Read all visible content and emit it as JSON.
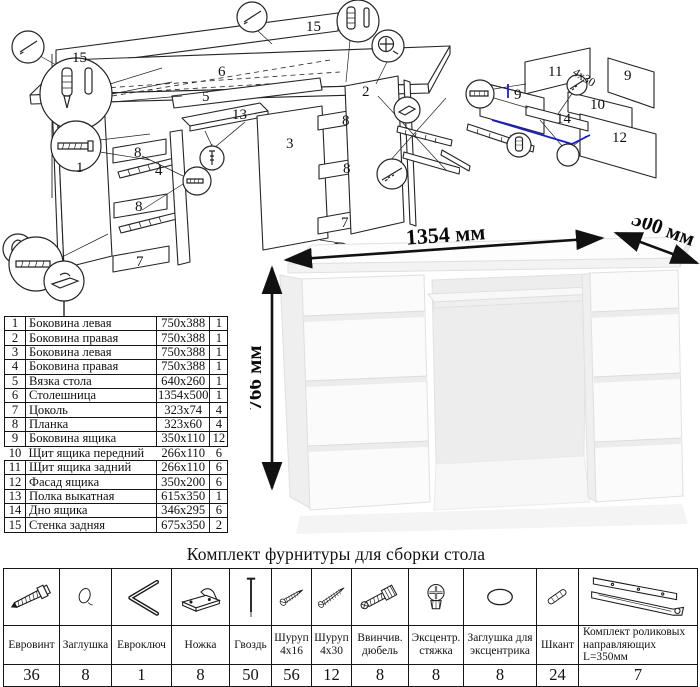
{
  "main_diagram": {
    "labels": [
      {
        "t": "15",
        "x": 72,
        "y": 62
      },
      {
        "t": "6",
        "x": 218,
        "y": 76
      },
      {
        "t": "15",
        "x": 306,
        "y": 31
      },
      {
        "t": "1",
        "x": 76,
        "y": 172
      },
      {
        "t": "8",
        "x": 134,
        "y": 157
      },
      {
        "t": "4",
        "x": 155,
        "y": 175
      },
      {
        "t": "8",
        "x": 135,
        "y": 211
      },
      {
        "t": "7",
        "x": 136,
        "y": 266
      },
      {
        "t": "5",
        "x": 202,
        "y": 101
      },
      {
        "t": "13",
        "x": 232,
        "y": 119
      },
      {
        "t": "3",
        "x": 286,
        "y": 148
      },
      {
        "t": "2",
        "x": 362,
        "y": 96
      },
      {
        "t": "8",
        "x": 342,
        "y": 125
      },
      {
        "t": "8",
        "x": 343,
        "y": 173
      },
      {
        "t": "7",
        "x": 341,
        "y": 227
      }
    ]
  },
  "drawer_diagram": {
    "accent_blue": "#1c1ccd",
    "labels": [
      {
        "t": "11",
        "x": 108,
        "y": 48
      },
      {
        "t": "9",
        "x": 184,
        "y": 52
      },
      {
        "t": "9",
        "x": 74,
        "y": 71
      },
      {
        "t": "10",
        "x": 150,
        "y": 81
      },
      {
        "t": "12",
        "x": 172,
        "y": 114
      },
      {
        "t": "14",
        "x": 116,
        "y": 95
      },
      {
        "t": "4x30",
        "x": 132,
        "y": 46,
        "r": 33,
        "s": 12
      }
    ]
  },
  "parts_table": {
    "rows": [
      [
        "1",
        "Боковина левая",
        "750x388",
        "1"
      ],
      [
        "2",
        "Боковина правая",
        "750x388",
        "1"
      ],
      [
        "3",
        "Боковина левая",
        "750x388",
        "1"
      ],
      [
        "4",
        "Боковина правая",
        "750x388",
        "1"
      ],
      [
        "5",
        "Вязка стола",
        "640x260",
        "1"
      ],
      [
        "6",
        "Столешница",
        "1354x500",
        "1"
      ],
      [
        "7",
        "Цоколь",
        "323x74",
        "4"
      ],
      [
        "8",
        "Планка",
        "323x60",
        "4"
      ],
      [
        "9",
        "Боковина ящика",
        "350x110",
        "12"
      ],
      [
        "10",
        "Щит ящика передний",
        "266x110",
        "6"
      ],
      [
        "11",
        "Щит ящика задний",
        "266x110",
        "6"
      ],
      [
        "12",
        "Фасад ящика",
        "350x200",
        "6"
      ],
      [
        "13",
        "Полка выкатная",
        "615x350",
        "1"
      ],
      [
        "14",
        "Дно ящика",
        "346x295",
        "6"
      ],
      [
        "15",
        "Стенка задняя",
        "675x350",
        "2"
      ]
    ]
  },
  "photo": {
    "width_label": "1354 мм",
    "depth_label": "500 мм",
    "height_label": "766 мм"
  },
  "hardware": {
    "title": "Комплект фурнитуры для сборки стола",
    "items": [
      {
        "name": "Евровинт",
        "qty": "36",
        "icon": "euro-screw"
      },
      {
        "name": "Заглушка",
        "qty": "8",
        "icon": "cap"
      },
      {
        "name": "Евроключ",
        "qty": "1",
        "icon": "hex-key"
      },
      {
        "name": "Ножка",
        "qty": "8",
        "icon": "foot"
      },
      {
        "name": "Гвоздь",
        "qty": "50",
        "icon": "nail"
      },
      {
        "name": "Шуруп 4x16",
        "qty": "56",
        "icon": "screw-small"
      },
      {
        "name": "Шуруп 4x30",
        "qty": "12",
        "icon": "screw-long"
      },
      {
        "name": "Ввинчив. дюбель",
        "qty": "8",
        "icon": "dowel"
      },
      {
        "name": "Эксцентр. стяжка",
        "qty": "8",
        "icon": "cam-lock"
      },
      {
        "name": "Заглушка для эксцентрика",
        "qty": "8",
        "icon": "cam-cap"
      },
      {
        "name": "Шкант",
        "qty": "24",
        "icon": "wood-dowel"
      },
      {
        "name": "Комплект роликовых направляющих L=350мм",
        "qty": "7",
        "icon": "rail-set"
      }
    ]
  }
}
